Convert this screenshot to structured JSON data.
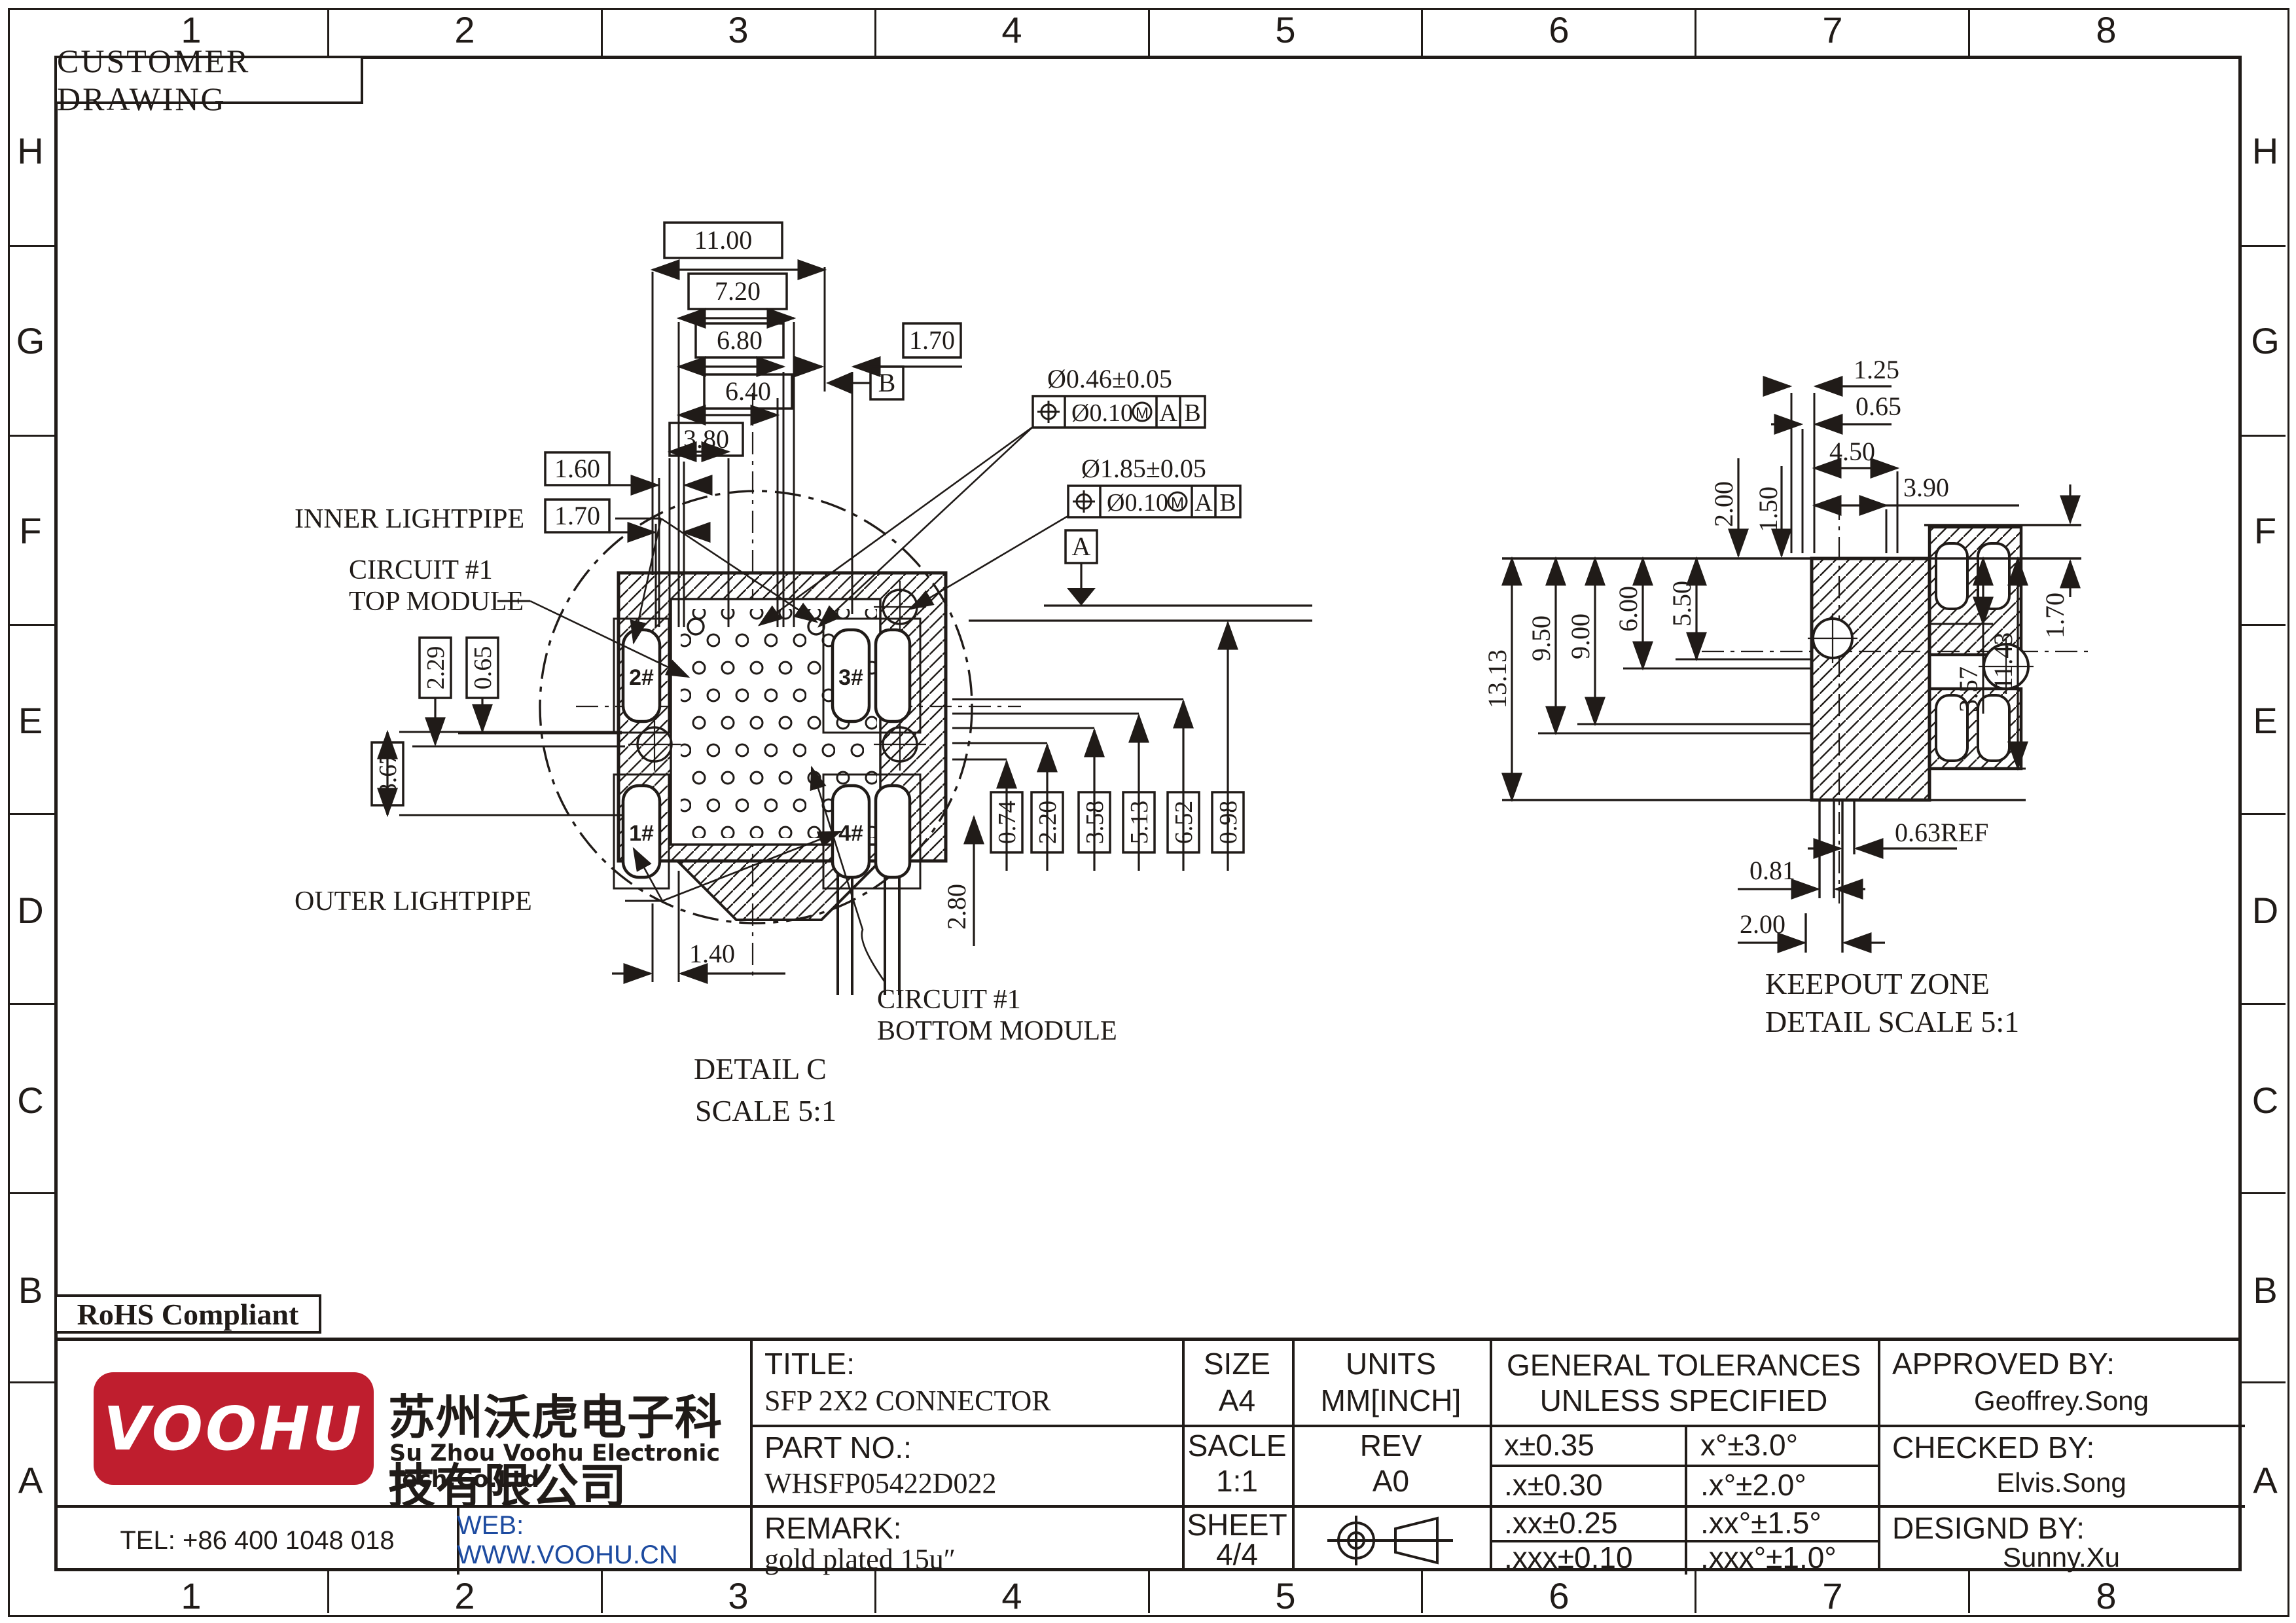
{
  "colors": {
    "line": "#201b18",
    "logo_red": "#bf1e2e",
    "web_blue": "#1d4ba0"
  },
  "border": {
    "columns": [
      "1",
      "2",
      "3",
      "4",
      "5",
      "6",
      "7",
      "8"
    ],
    "rows": [
      "H",
      "G",
      "F",
      "E",
      "D",
      "C",
      "B",
      "A"
    ]
  },
  "header": {
    "customer_drawing": "CUSTOMER DRAWING",
    "rohs": "RoHS Compliant"
  },
  "detail_c": {
    "labels": {
      "inner_lightpipe": "INNER LIGHTPIPE",
      "circuit_top_1": "CIRCUIT #1",
      "circuit_top_2": "TOP MODULE",
      "outer_lightpipe": "OUTER LIGHTPIPE",
      "circuit_bottom_1": "CIRCUIT #1",
      "circuit_bottom_2": "BOTTOM MODULE",
      "title_1": "DETAIL C",
      "title_2": "SCALE 5:1"
    },
    "slots": {
      "s1": "1#",
      "s2": "2#",
      "s3": "3#",
      "s4": "4#"
    },
    "datums": {
      "a": "A",
      "b": "B"
    },
    "fcf1": {
      "size": "Ø0.46±0.05",
      "tol": "Ø0.10",
      "mod": "M",
      "d1": "A",
      "d2": "B"
    },
    "fcf2": {
      "size": "Ø1.85±0.05",
      "tol": "Ø0.10",
      "mod": "M",
      "d1": "A",
      "d2": "B"
    },
    "dims": {
      "d11_00": "11.00",
      "d7_20": "7.20",
      "d6_80": "6.80",
      "d6_40": "6.40",
      "d3_80": "3.80",
      "d1_60": "1.60",
      "d1_70a": "1.70",
      "d1_70b": "1.70",
      "d2_29": "2.29",
      "d0_65": "0.65",
      "d3_67": "3.67",
      "d1_40": "1.40",
      "d2_80": "2.80",
      "d0_74": "0.74",
      "d2_20": "2.20",
      "d3_58": "3.58",
      "d5_13": "5.13",
      "d6_52": "6.52",
      "d0_98": "0.98"
    }
  },
  "keepout": {
    "labels": {
      "title_1": "KEEPOUT ZONE",
      "title_2": "DETAIL SCALE 5:1"
    },
    "dims": {
      "d1_25": "1.25",
      "d0_65": "0.65",
      "d4_50": "4.50",
      "d3_90": "3.90",
      "d2_00_top": "2.00",
      "d1_50": "1.50",
      "d13_13": "13.13",
      "d9_50": "9.50",
      "d9_00": "9.00",
      "d6_00": "6.00",
      "d5_50": "5.50",
      "d3_57": "3.57",
      "d11_43": "11.43",
      "d1_70": "1.70",
      "d0_63ref": "0.63REF",
      "d0_81": "0.81",
      "d2_00_bot": "2.00"
    }
  },
  "title_block": {
    "title_label": "TITLE:",
    "title_value": "SFP 2X2 CONNECTOR",
    "part_label": "PART NO.:",
    "part_value": "WHSFP05422D022",
    "remark_label": "REMARK:",
    "remark_value": "gold plated 15u″",
    "size_label": "SIZE",
    "size_value": "A4",
    "scale_label": "SACLE",
    "scale_value": "1:1",
    "sheet_label": "SHEET",
    "sheet_value": "4/4",
    "units_label": "UNITS",
    "units_value": "MM[INCH]",
    "rev_label": "REV",
    "rev_value": "A0",
    "tol_header1": "GENERAL TOLERANCES",
    "tol_header2": "UNLESS SPECIFIED",
    "tol_rows": [
      {
        "lin": "x±0.35",
        "ang": "x°±3.0°"
      },
      {
        "lin": ".x±0.30",
        "ang": ".x°±2.0°"
      },
      {
        "lin": ".xx±0.25",
        "ang": ".xx°±1.5°"
      },
      {
        "lin": ".xxx±0.10",
        "ang": ".xxx°±1.0°"
      }
    ],
    "approved_label": "APPROVED BY:",
    "approved_value": "Geoffrey.Song",
    "checked_label": "CHECKED BY:",
    "checked_value": "Elvis.Song",
    "designed_label": "DESIGND BY:",
    "designed_value": "Sunny.Xu",
    "company": {
      "logo": "VOOHU",
      "cn": "苏州沃虎电子科技有限公司",
      "en": "Su Zhou Voohu Electronic Tech.Co.Ltd"
    },
    "tel": "TEL: +86 400 1048 018",
    "web": "WEB: WWW.VOOHU.CN"
  }
}
